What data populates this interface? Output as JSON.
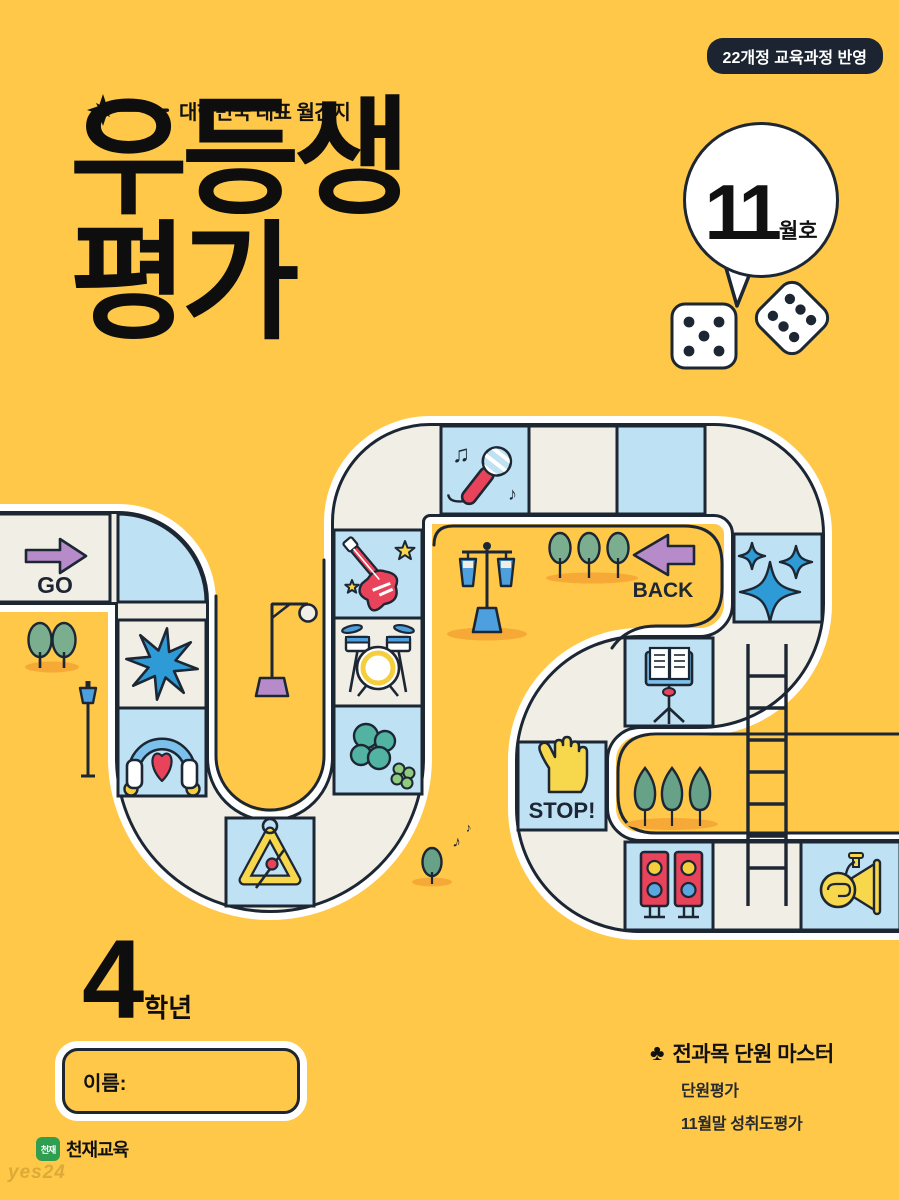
{
  "badge": {
    "label": "22개정 교육과정 반영"
  },
  "tagline": {
    "text": "대한민국 대표 월간지"
  },
  "title": {
    "line1": "우등생",
    "line2": "평가"
  },
  "issue": {
    "number": "11",
    "suffix": "월호"
  },
  "board": {
    "go_label": "GO",
    "back_label": "BACK",
    "stop_label": "STOP!",
    "tiles": [
      "go",
      "star",
      "headphones",
      "triangle",
      "clover",
      "drums",
      "guitar",
      "microphone",
      "back",
      "sparkles",
      "music-stand",
      "stop",
      "speakers",
      "ladder",
      "tuba"
    ]
  },
  "grade": {
    "number": "4",
    "label": "학년"
  },
  "name_field": {
    "label": "이름:"
  },
  "features": {
    "bullet": "♣",
    "heading": "전과목 단원 마스터",
    "items": [
      "단원평가",
      "11월말 성취도평가"
    ]
  },
  "publisher": {
    "logo_text": "천재",
    "name": "천재교육"
  },
  "watermark": "yes24",
  "colors": {
    "background": "#FFC848",
    "tile_cream": "#F1EEE6",
    "tile_blue": "#BFE1F4",
    "outline": "#1C2733",
    "accent_red": "#E8435A",
    "accent_purple": "#B78BC9",
    "accent_blue": "#2E9AD6",
    "accent_yellow": "#F7D74C",
    "accent_teal": "#53B3A2",
    "shadow_orange": "#F7A938"
  }
}
